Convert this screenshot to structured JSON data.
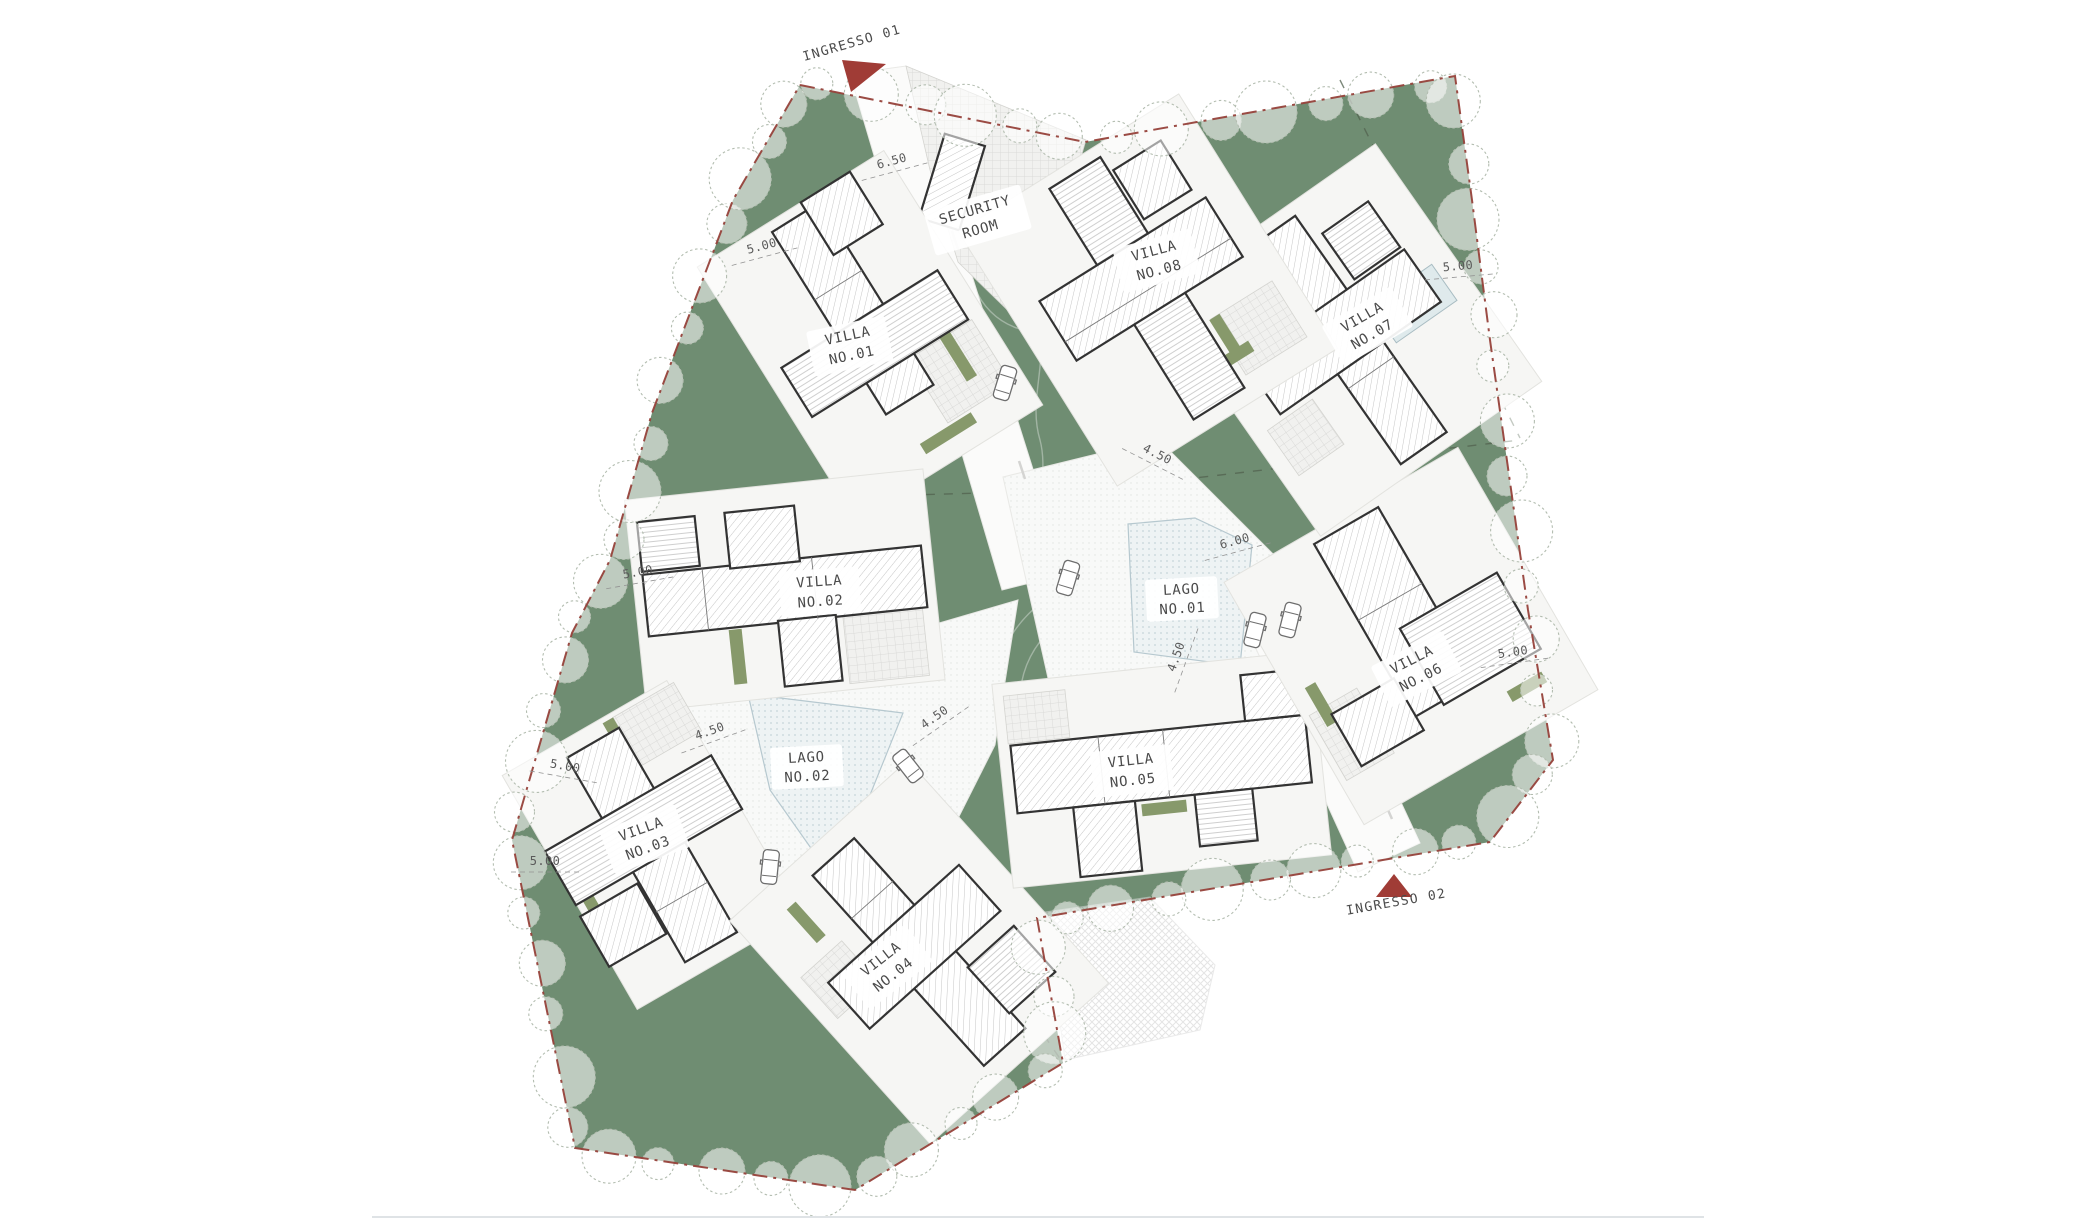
{
  "plan": {
    "villas": [
      {
        "id": "villa-no-01",
        "line1": "VILLA",
        "line2": "NO.01"
      },
      {
        "id": "villa-no-02",
        "line1": "VILLA",
        "line2": "NO.02"
      },
      {
        "id": "villa-no-03",
        "line1": "VILLA",
        "line2": "NO.03"
      },
      {
        "id": "villa-no-04",
        "line1": "VILLA",
        "line2": "NO.04"
      },
      {
        "id": "villa-no-05",
        "line1": "VILLA",
        "line2": "NO.05"
      },
      {
        "id": "villa-no-06",
        "line1": "VILLA",
        "line2": "NO.06"
      },
      {
        "id": "villa-no-07",
        "line1": "VILLA",
        "line2": "NO.07"
      },
      {
        "id": "villa-no-08",
        "line1": "VILLA",
        "line2": "NO.08"
      }
    ],
    "lakes": [
      {
        "id": "lago-no-01",
        "line1": "LAGO",
        "line2": "NO.01"
      },
      {
        "id": "lago-no-02",
        "line1": "LAGO",
        "line2": "NO.02"
      }
    ],
    "security_room": {
      "line1": "SECURITY",
      "line2": "ROOM"
    },
    "entrances": [
      {
        "id": "ingresso-01",
        "label": "INGRESSO 01"
      },
      {
        "id": "ingresso-02",
        "label": "INGRESSO 02"
      }
    ],
    "dimensions": [
      {
        "value": "6.50"
      },
      {
        "value": "5.00"
      },
      {
        "value": "5.00"
      },
      {
        "value": "5.00"
      },
      {
        "value": "5.00"
      },
      {
        "value": "4.50"
      },
      {
        "value": "4.50"
      },
      {
        "value": "4.50"
      },
      {
        "value": "4.50"
      },
      {
        "value": "6.00"
      },
      {
        "value": "5.00"
      },
      {
        "value": "5.00"
      }
    ],
    "colors": {
      "site_green": "#6f8d72",
      "road": "#fbfbfa",
      "water": "#eef3f4",
      "boundary": "#96413a",
      "entrance_marker": "#a03c36",
      "text": "#4a4a4a"
    }
  }
}
